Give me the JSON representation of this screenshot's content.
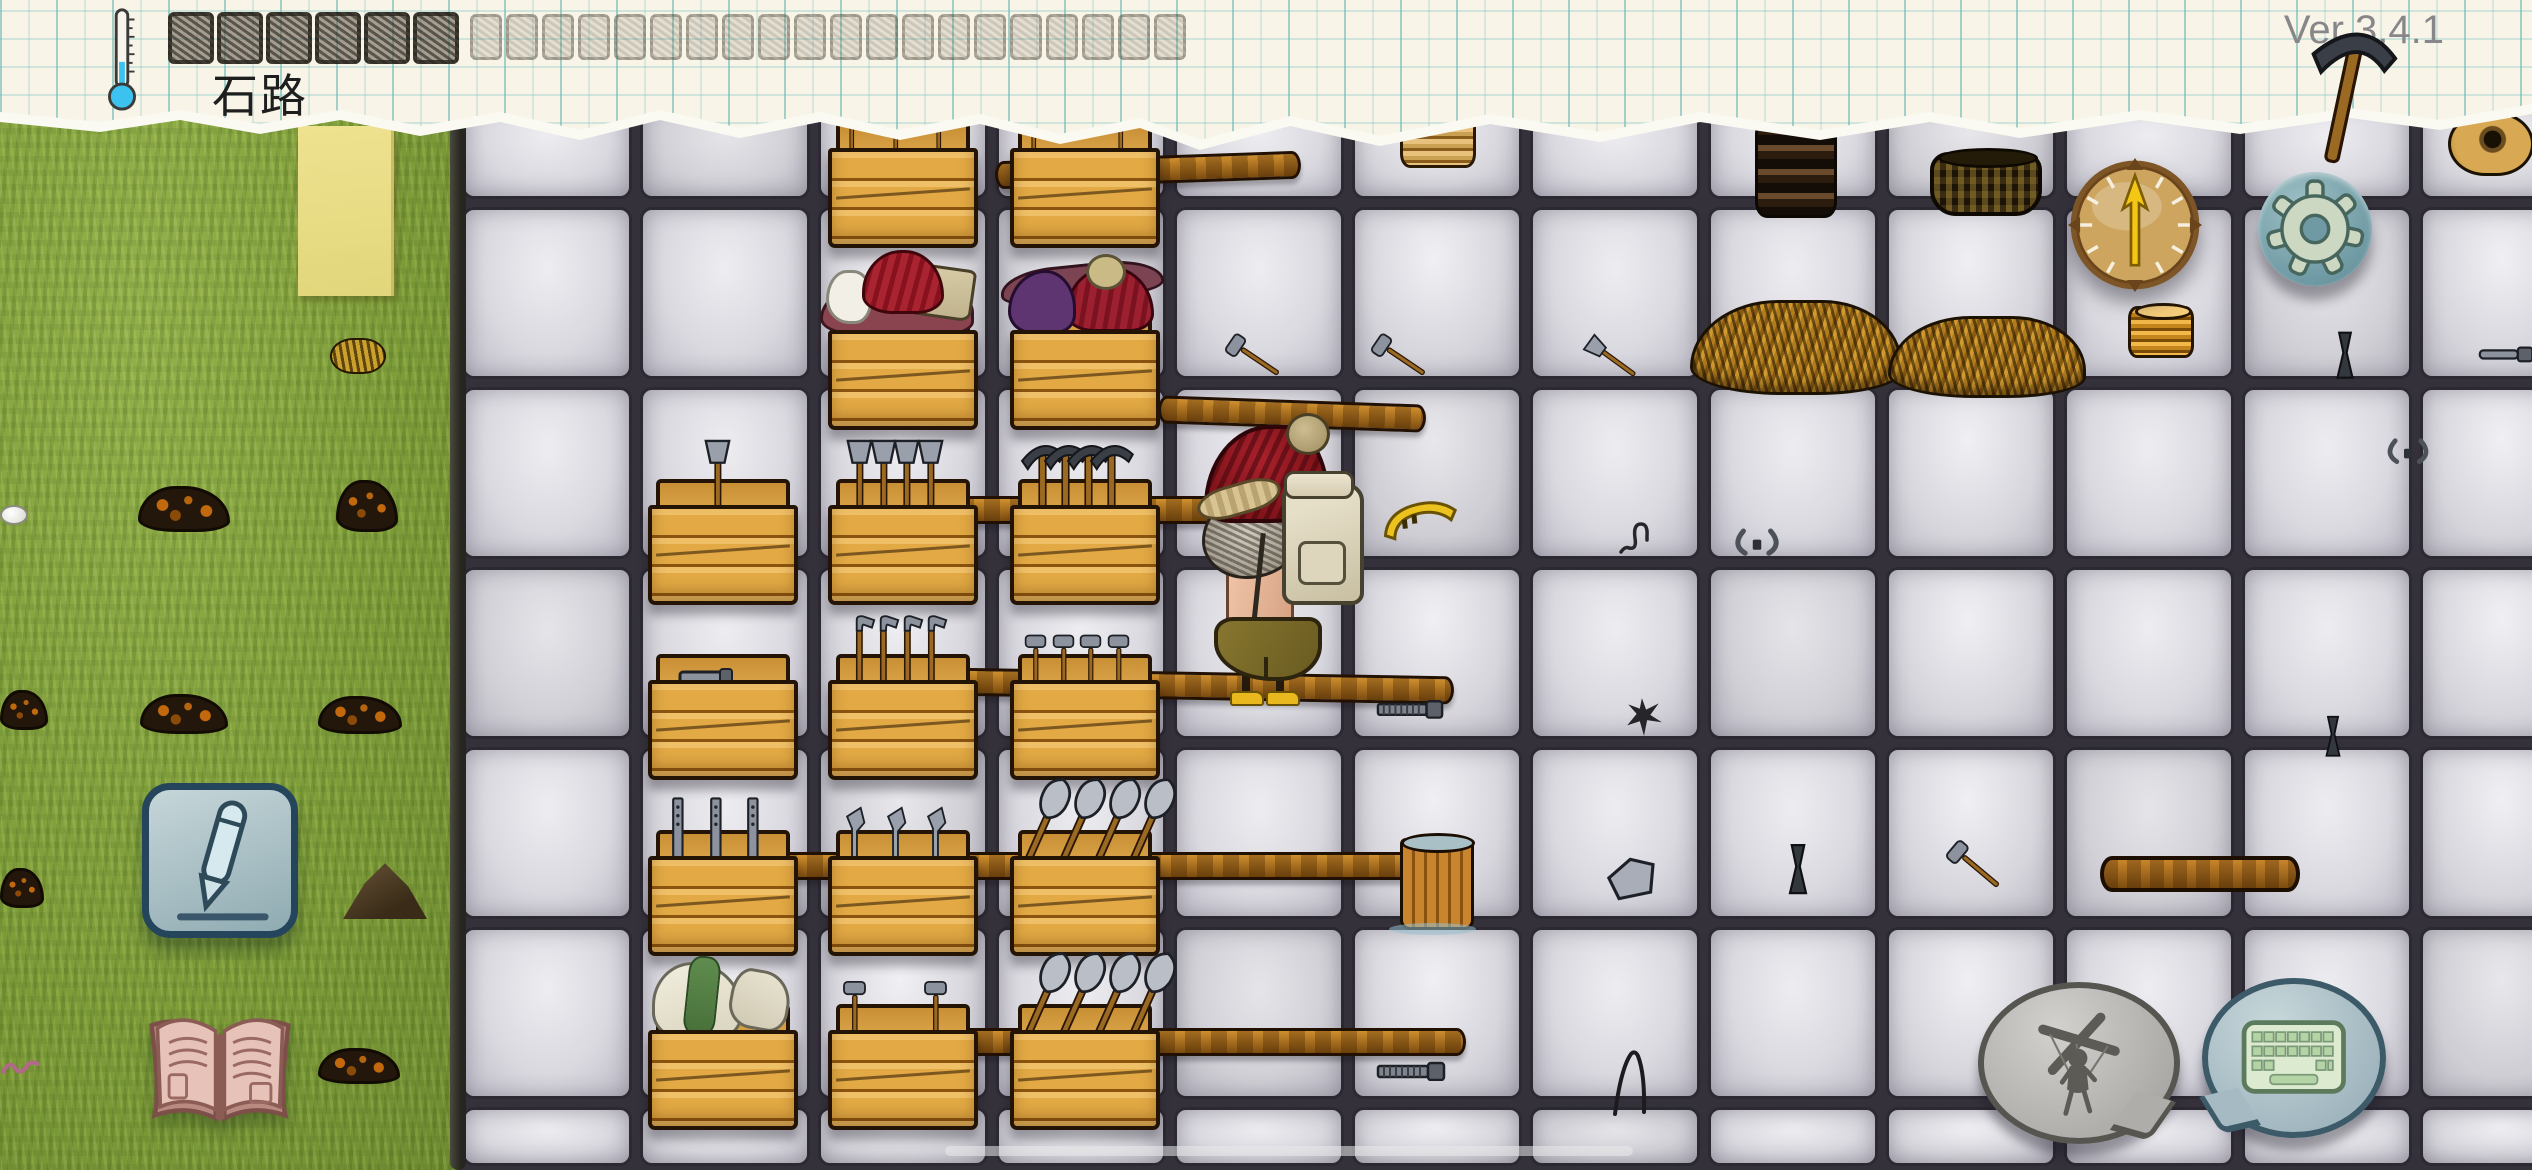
{
  "app": {
    "location_label": "石路",
    "version_label": "Ver 3.4.1"
  },
  "palette": {
    "paper": "#f8f5e8",
    "grid_line": "#8cc8c3",
    "grass": "#7d9c38",
    "stone": "#d9d8df",
    "stone_gap": "#2c2933",
    "wood": "#e2a944",
    "hat_red": "#a8212c",
    "thermo_blue": "#3cc2ee"
  },
  "topbar": {
    "dark_slots": 6,
    "faint_slots": 20
  },
  "world": {
    "character": {
      "x": 1198,
      "y": 425
    },
    "shafts": [
      {
        "x": 995,
        "y": 156,
        "w": 300,
        "rot": -2
      },
      {
        "x": 1158,
        "y": 400,
        "w": 262,
        "rot": 2
      },
      {
        "x": 955,
        "y": 496,
        "w": 292,
        "rot": 0
      },
      {
        "x": 948,
        "y": 672,
        "w": 500,
        "rot": 1
      },
      {
        "x": 778,
        "y": 852,
        "w": 685,
        "rot": 0
      },
      {
        "x": 948,
        "y": 1028,
        "w": 512,
        "rot": 0
      }
    ],
    "crates": [
      {
        "x": 828,
        "y": 148,
        "tools": {
          "type": "hammer",
          "count": 3,
          "h": 52
        }
      },
      {
        "x": 1010,
        "y": 148,
        "tools": {
          "type": "hammer",
          "count": 2,
          "h": 52
        }
      },
      {
        "x": 828,
        "y": 330,
        "cloth": "red"
      },
      {
        "x": 1010,
        "y": 330,
        "cloth": "purple"
      },
      {
        "x": 648,
        "y": 505,
        "tools": {
          "type": "axe",
          "count": 1,
          "h": 78
        }
      },
      {
        "x": 828,
        "y": 505,
        "tools": {
          "type": "axe",
          "count": 4,
          "h": 78
        }
      },
      {
        "x": 1010,
        "y": 505,
        "tools": {
          "type": "pickaxe",
          "count": 4,
          "h": 82
        }
      },
      {
        "x": 648,
        "y": 680,
        "tools": {
          "type": "flat",
          "count": 1,
          "h": 24
        }
      },
      {
        "x": 828,
        "y": 680,
        "tools": {
          "type": "adze",
          "count": 4,
          "h": 76
        }
      },
      {
        "x": 1010,
        "y": 680,
        "tools": {
          "type": "hammer",
          "count": 4,
          "h": 58
        }
      },
      {
        "x": 648,
        "y": 856,
        "tools": {
          "type": "file",
          "count": 3,
          "h": 72
        }
      },
      {
        "x": 828,
        "y": 856,
        "tools": {
          "type": "blade",
          "count": 3,
          "h": 62
        }
      },
      {
        "x": 1010,
        "y": 856,
        "tools": {
          "type": "shovel",
          "count": 4,
          "h": 92,
          "rot": 24
        }
      },
      {
        "x": 648,
        "y": 1030,
        "cloth": "white"
      },
      {
        "x": 828,
        "y": 1030,
        "tools": {
          "type": "hammer",
          "count": 2,
          "h": 62
        }
      },
      {
        "x": 1010,
        "y": 1030,
        "tools": {
          "type": "shovel",
          "count": 4,
          "h": 92,
          "rot": 24
        }
      }
    ],
    "items": [
      {
        "name": "plate-stack",
        "type": "stack-tan",
        "x": 1400,
        "y": 112,
        "w": 76,
        "h": 56
      },
      {
        "name": "clay-ring-stack",
        "type": "stack-dark",
        "x": 1755,
        "y": 118,
        "w": 82,
        "h": 100
      },
      {
        "name": "basket",
        "type": "basket",
        "x": 1930,
        "y": 152,
        "w": 112,
        "h": 64
      },
      {
        "name": "pickaxe",
        "type": "svg",
        "sym": "pickaxe",
        "x": 2282,
        "y": 8,
        "w": 130,
        "h": 158,
        "rot": 12,
        "z": 55
      },
      {
        "name": "clay-coil",
        "type": "clay-coil",
        "x": 2448,
        "y": 112,
        "w": 86,
        "h": 64
      },
      {
        "name": "mallet",
        "type": "svg",
        "sym": "hammer",
        "x": 1222,
        "y": 326,
        "w": 62,
        "h": 62,
        "rot": -56
      },
      {
        "name": "mallet",
        "type": "svg",
        "sym": "hammer",
        "x": 1368,
        "y": 326,
        "w": 62,
        "h": 62,
        "rot": -56
      },
      {
        "name": "hatchet",
        "type": "svg",
        "sym": "axe",
        "x": 1582,
        "y": 328,
        "w": 58,
        "h": 60,
        "rot": -54
      },
      {
        "name": "kindling-pile",
        "type": "straw",
        "x": 1690,
        "y": 300,
        "w": 212,
        "h": 95
      },
      {
        "name": "kindling-pile",
        "type": "straw",
        "x": 1888,
        "y": 316,
        "w": 198,
        "h": 82
      },
      {
        "name": "plate-stack-gold",
        "type": "plates-gold",
        "x": 2128,
        "y": 306,
        "w": 66,
        "h": 52
      },
      {
        "name": "chisel",
        "type": "svg",
        "sym": "chisel",
        "x": 2330,
        "y": 330,
        "w": 30,
        "h": 52
      },
      {
        "name": "metal-rod",
        "type": "svg",
        "sym": "rod",
        "x": 2478,
        "y": 344,
        "w": 58,
        "h": 20
      },
      {
        "name": "sickle",
        "type": "svg",
        "sym": "sickle",
        "x": 1380,
        "y": 498,
        "w": 80,
        "h": 44,
        "rot": -6
      },
      {
        "name": "wire-scrap",
        "type": "svg",
        "sym": "wire",
        "x": 1616,
        "y": 516,
        "w": 46,
        "h": 40
      },
      {
        "name": "tongs",
        "type": "svg",
        "sym": "tongs",
        "x": 1730,
        "y": 526,
        "w": 54,
        "h": 34
      },
      {
        "name": "tongs",
        "type": "svg",
        "sym": "tongs",
        "x": 2384,
        "y": 436,
        "w": 48,
        "h": 32
      },
      {
        "name": "metal-file",
        "type": "svg",
        "sym": "file-g",
        "x": 1376,
        "y": 698,
        "w": 70,
        "h": 22
      },
      {
        "name": "metal-scraps",
        "type": "svg",
        "sym": "scraps",
        "x": 1624,
        "y": 696,
        "w": 40,
        "h": 42
      },
      {
        "name": "chisel",
        "type": "svg",
        "sym": "chisel",
        "x": 2320,
        "y": 714,
        "w": 26,
        "h": 46
      },
      {
        "name": "bucket",
        "type": "bucket",
        "x": 1400,
        "y": 838,
        "w": 74,
        "h": 92
      },
      {
        "name": "axe-head",
        "type": "svg",
        "sym": "axehead",
        "x": 1604,
        "y": 856,
        "w": 56,
        "h": 46,
        "rot": -8
      },
      {
        "name": "chisel",
        "type": "svg",
        "sym": "chisel",
        "x": 1782,
        "y": 842,
        "w": 32,
        "h": 56
      },
      {
        "name": "mallet",
        "type": "svg",
        "sym": "hammer",
        "x": 1942,
        "y": 834,
        "w": 64,
        "h": 64,
        "rot": -50
      },
      {
        "name": "log",
        "type": "log",
        "x": 2100,
        "y": 856,
        "w": 200,
        "h": 36
      },
      {
        "name": "metal-file",
        "type": "svg",
        "sym": "file-g",
        "x": 1376,
        "y": 1060,
        "w": 72,
        "h": 22
      },
      {
        "name": "bent-wire",
        "type": "svg",
        "sym": "bigwire",
        "x": 1606,
        "y": 1046,
        "w": 52,
        "h": 72
      },
      {
        "name": "paper-note",
        "type": "note",
        "x": 298,
        "y": 126,
        "w": 96,
        "h": 170
      },
      {
        "name": "wheat-head",
        "type": "wheat-head",
        "x": 330,
        "y": 338,
        "w": 56,
        "h": 36
      },
      {
        "name": "dirt-pile",
        "type": "dirt",
        "x": 138,
        "y": 486,
        "w": 92,
        "h": 46
      },
      {
        "name": "dirt-pile",
        "type": "dirt",
        "x": 336,
        "y": 480,
        "w": 62,
        "h": 52
      },
      {
        "name": "egg",
        "type": "egg",
        "x": 0,
        "y": 505,
        "w": 28,
        "h": 20
      },
      {
        "name": "dirt-pile",
        "type": "dirt",
        "x": 0,
        "y": 690,
        "w": 48,
        "h": 40
      },
      {
        "name": "dirt-pile",
        "type": "dirt",
        "x": 140,
        "y": 694,
        "w": 88,
        "h": 40
      },
      {
        "name": "dirt-pile",
        "type": "dirt",
        "x": 318,
        "y": 696,
        "w": 84,
        "h": 38
      },
      {
        "name": "dirt-pile",
        "type": "dirt",
        "x": 0,
        "y": 868,
        "w": 44,
        "h": 40
      },
      {
        "name": "dirt-mound",
        "type": "dirt-mound",
        "x": 343,
        "y": 862,
        "w": 84,
        "h": 62
      },
      {
        "name": "dirt-pile",
        "type": "dirt",
        "x": 318,
        "y": 1048,
        "w": 82,
        "h": 36
      },
      {
        "name": "worm",
        "type": "svg",
        "sym": "worm",
        "x": 0,
        "y": 1056,
        "w": 44,
        "h": 28
      }
    ]
  }
}
